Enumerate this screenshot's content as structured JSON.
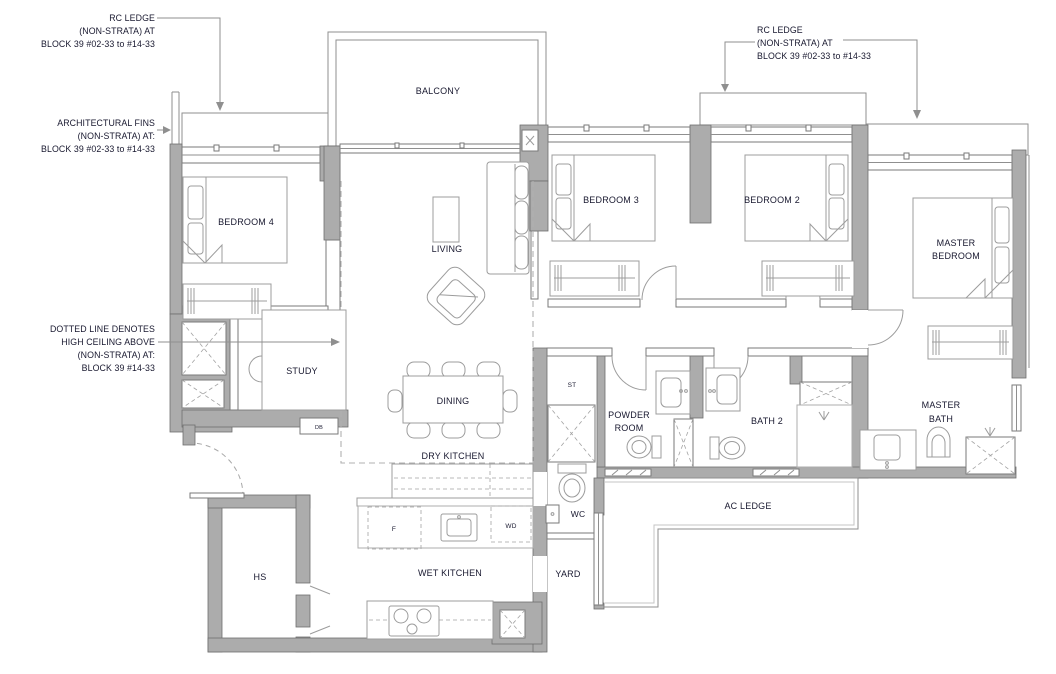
{
  "document": {
    "type": "residential floor plan"
  },
  "colors": {
    "background": "#ffffff",
    "wall_fill": "#acacac",
    "wall_stroke": "#6f6f6f",
    "thin_line": "#8f8f8f",
    "furniture_line": "#9c9c9c",
    "dashed_line": "#b0b0b0",
    "text": "#18182f"
  },
  "annotations": {
    "rc_ledge_left": {
      "lines": [
        "RC LEDGE",
        "(NON-STRATA) AT",
        "BLOCK 39 #02-33 to #14-33"
      ]
    },
    "architectural_fins": {
      "lines": [
        "ARCHITECTURAL FINS",
        "(NON-STRATA) AT:",
        "BLOCK 39 #02-33 to #14-33"
      ]
    },
    "high_ceiling_note": {
      "lines": [
        "DOTTED LINE DENOTES",
        "HIGH CEILING ABOVE",
        "(NON-STRATA) AT:",
        "BLOCK 39 #14-33"
      ]
    },
    "rc_ledge_right": {
      "lines": [
        "RC LEDGE",
        "(NON-STRATA) AT",
        "BLOCK 39 #02-33 to #14-33"
      ]
    }
  },
  "rooms": {
    "balcony": {
      "label": "BALCONY"
    },
    "living": {
      "label": "LIVING"
    },
    "dining": {
      "label": "DINING"
    },
    "dry_kitchen": {
      "label": "DRY KITCHEN"
    },
    "wet_kitchen": {
      "label": "WET KITCHEN"
    },
    "bedroom_4": {
      "label": "BEDROOM 4"
    },
    "bedroom_3": {
      "label": "BEDROOM 3"
    },
    "bedroom_2": {
      "label": "BEDROOM 2"
    },
    "master_bedroom": {
      "line1": "MASTER",
      "line2": "BEDROOM"
    },
    "study": {
      "label": "STUDY"
    },
    "powder_room": {
      "line1": "POWDER",
      "line2": "ROOM"
    },
    "bath_2": {
      "label": "BATH 2"
    },
    "master_bath": {
      "line1": "MASTER",
      "line2": "BATH"
    },
    "wc": {
      "label": "WC"
    },
    "yard": {
      "label": "YARD"
    },
    "store": {
      "label": "ST"
    },
    "household_shelter": {
      "label": "HS"
    },
    "ac_ledge": {
      "label": "AC LEDGE"
    }
  },
  "equipment": {
    "db": "DB",
    "fridge": "F",
    "washer_dryer": "WD"
  }
}
